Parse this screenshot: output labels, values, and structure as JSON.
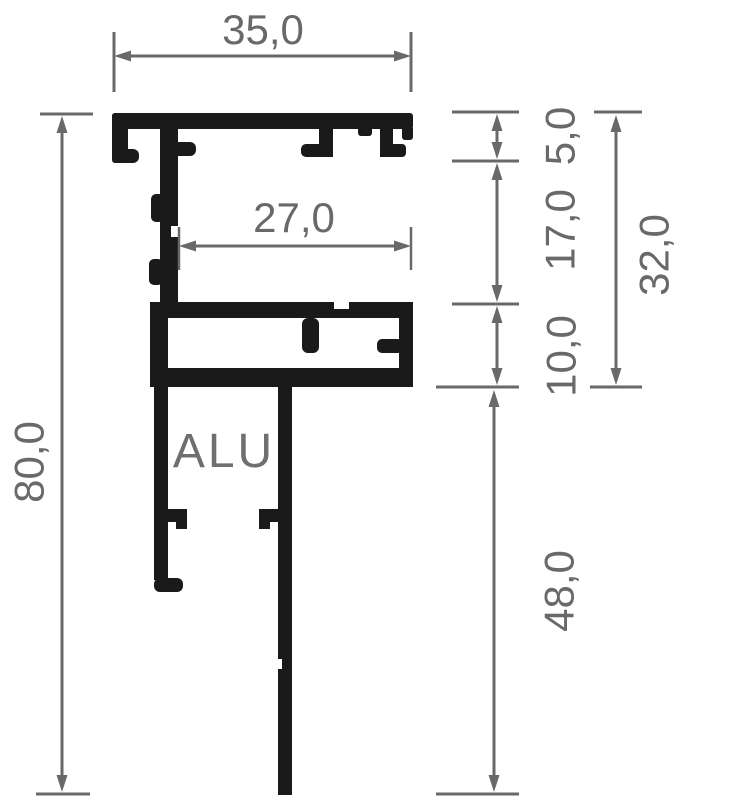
{
  "drawing": {
    "material_label": "ALU",
    "dims": {
      "top_width": "35,0",
      "inner_width": "27,0",
      "total_height": "80,0",
      "lip_height": "5,0",
      "upper_height": "17,0",
      "mid_height": "10,0",
      "upper_total_height": "32,0",
      "lower_height": "48,0"
    },
    "colors": {
      "profile": "#1a1a1a",
      "dimension": "#696969",
      "background": "#ffffff"
    }
  }
}
